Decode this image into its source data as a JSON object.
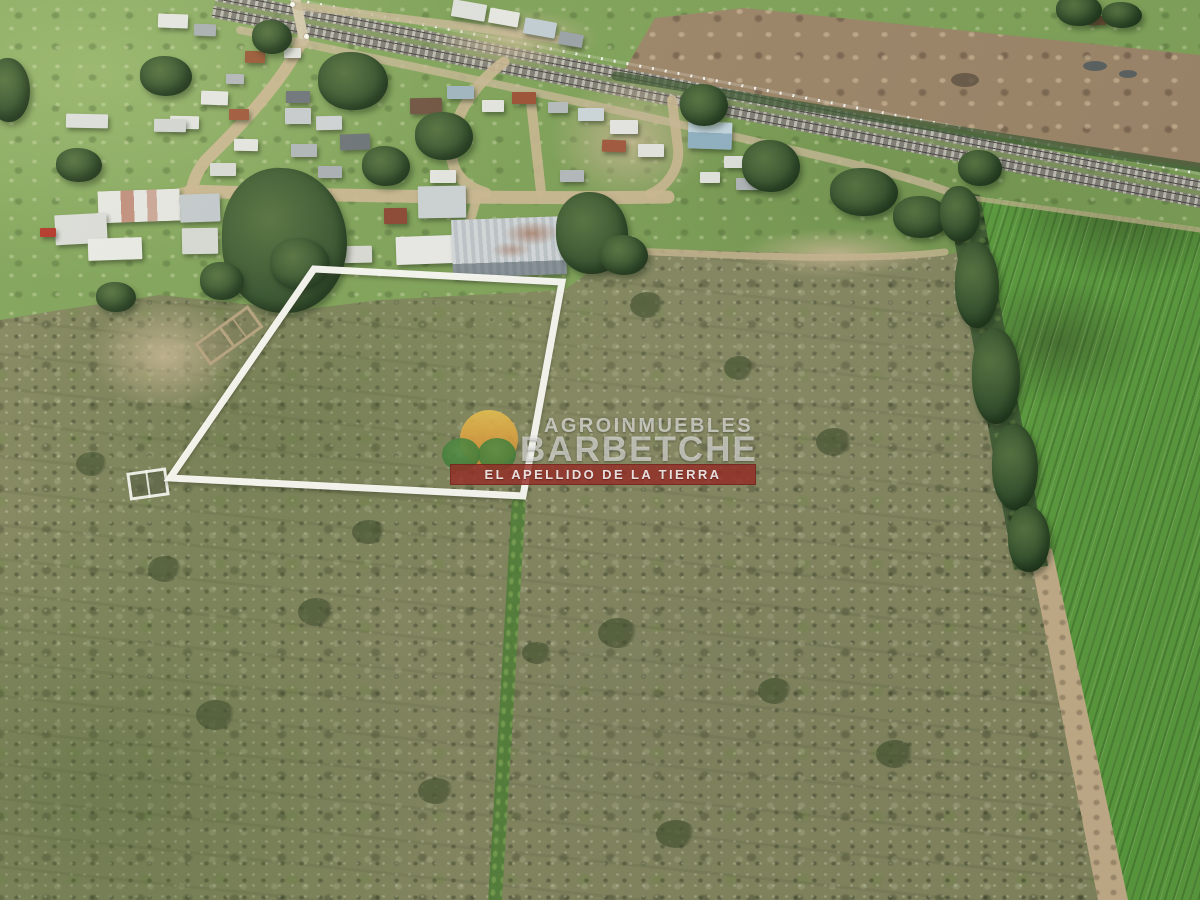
{
  "watermark": {
    "brand_top": "AGROINMUEBLES",
    "brand_main": "BARBETCHE",
    "tagline": "EL APELLIDO DE LA TIERRA",
    "logo_icon": "sun-over-green-hills",
    "colors": {
      "banner_red": "#96241e",
      "sun_orange": "#dfa23c",
      "hill_green": "#3e7c35",
      "text_white": "#ffffff"
    }
  },
  "scene": {
    "plot_outline_color": "#fbfbf6"
  }
}
